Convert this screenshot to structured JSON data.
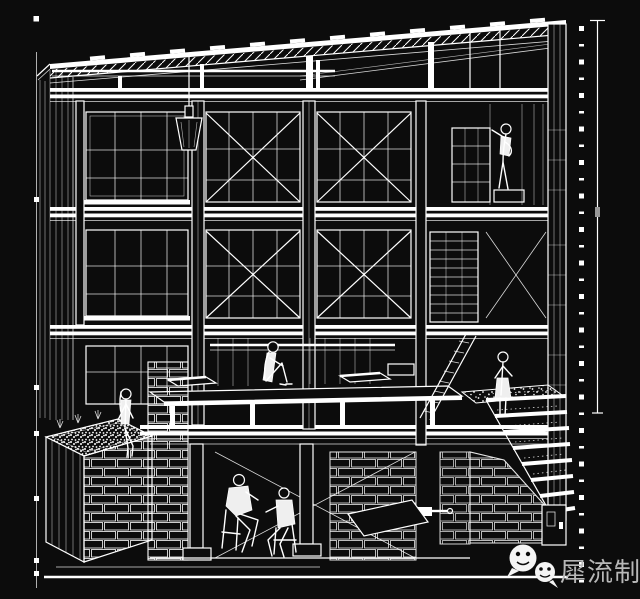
{
  "canvas": {
    "width": 640,
    "height": 599,
    "background": "#0c0c0c",
    "line_color": "#ffffff"
  },
  "drawing": {
    "kind": "architectural sectional perspective line drawing, white lines on black",
    "levels": [
      "mono-pitch roof with rafters and purlins",
      "upper gallery floor with window mullions and X-bracing",
      "middle gallery floor with window mullions and X-bracing",
      "open deck / platform level",
      "basement level with masonry walls"
    ],
    "elements": [
      "left survey line with tick markers",
      "right survey line with square markers",
      "hanging lamp",
      "planter box with gravel top",
      "cascading gravel stairs",
      "inclined ladder",
      "shelf unit",
      "scaffold tower",
      "column base plates"
    ],
    "figures": [
      {
        "label": "person reaching a shelf",
        "location": "upper floor, right"
      },
      {
        "label": "person sitting with knees up",
        "location": "deck platform, center"
      },
      {
        "label": "person sitting on planter edge",
        "location": "left planter"
      },
      {
        "label": "person standing at stair landing",
        "location": "right landing"
      },
      {
        "label": "two seated people talking",
        "location": "basement"
      }
    ]
  },
  "watermark": {
    "text": "犀流制报",
    "color": "#b8b8b8",
    "icons": [
      {
        "name": "wechat-icon-large"
      },
      {
        "name": "wechat-icon-small"
      }
    ]
  }
}
